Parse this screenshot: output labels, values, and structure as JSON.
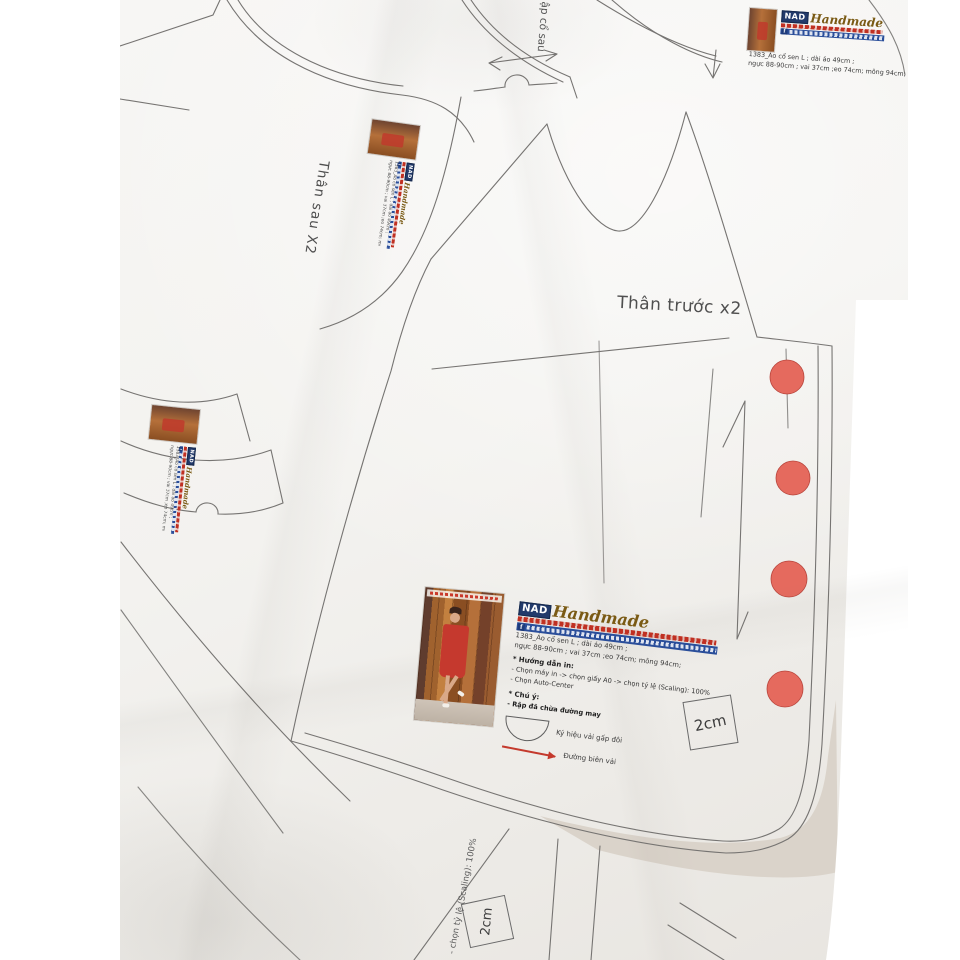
{
  "pattern_labels": {
    "front_body": "Thân trước x2",
    "back_body": "Thân sau X2",
    "back_collar": "ập cổ sau"
  },
  "scale_boxes": {
    "label": "2cm"
  },
  "edge_text": "- chọn tỷ lệ (Scaling): 100%",
  "brand": {
    "initials": "NAD",
    "script": "Handmade",
    "facebook_icon": "f"
  },
  "product_info": {
    "line1": "1383_Áo cổ sen L ; dài áo 49cm ;",
    "line2": "ngực 88-90cm ; vai 37cm ;eo 74cm; mông 94cm;"
  },
  "print_instructions": {
    "heading": "* Hướng dẫn in:",
    "step_printer": "- Chọn máy in -> chọn giấy A0 -> chọn tỷ lệ (Scaling): 100%",
    "step_center": "- Chọn Auto-Center"
  },
  "notes": {
    "heading": "* Chú ý:",
    "seam_allowance": "- Rập đã chừa đường may",
    "fold_symbol_label": "Ký hiệu vải gấp đôi",
    "selvage_label": "Đường biên vải"
  },
  "markers": {
    "button_dot_count": 4
  },
  "colors": {
    "paper": "#f2f1ee",
    "line": "#767472",
    "button_dot": "#e56a5e",
    "accent_red": "#c4392c",
    "logo_blue": "#2a4e9a",
    "logo_gold": "#7a5a14",
    "background_shadow": "#d9d2c8"
  }
}
